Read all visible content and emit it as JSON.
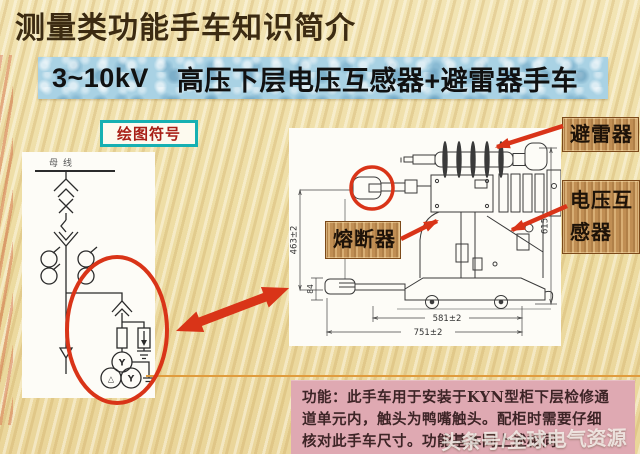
{
  "header": {
    "title": "测量类功能手车知识简介",
    "subtitle_voltage": "3~10kV",
    "subtitle_text": "高压下层电压互感器+避雷器手车"
  },
  "badge": {
    "label": "绘图符号"
  },
  "circuit": {
    "busbar_label": "母线",
    "winding_top": "Y",
    "winding_left": "△",
    "winding_right": "Y"
  },
  "part_labels": {
    "arrester": "避雷器",
    "vt_line1": "电压互",
    "vt_line2": "感器",
    "fuse": "熔断器"
  },
  "drawing": {
    "dim_height_left": "463±2",
    "dim_contact": "84",
    "dim_height_right": "615",
    "dim_width_inner": "581±2",
    "dim_width_outer": "751±2"
  },
  "function_box": {
    "lines": [
      "功能：此手车用于安装于KYN型柜下层检修通",
      "道单元内，触头为鸭嘴触头。配柜时需要仔细",
      "核对此手车尺寸。功能基本同上述相同"
    ]
  },
  "watermark": {
    "text": "头条号/全球电气资源"
  },
  "colors": {
    "accent_red": "#d93418",
    "banner_blue": "#a9d2e4",
    "wood_tan": "#c9995e",
    "pink_box": "#dfa9b2",
    "teal": "#17b0b2",
    "title_brown": "#3c2b12",
    "background": "#eedfa8"
  }
}
